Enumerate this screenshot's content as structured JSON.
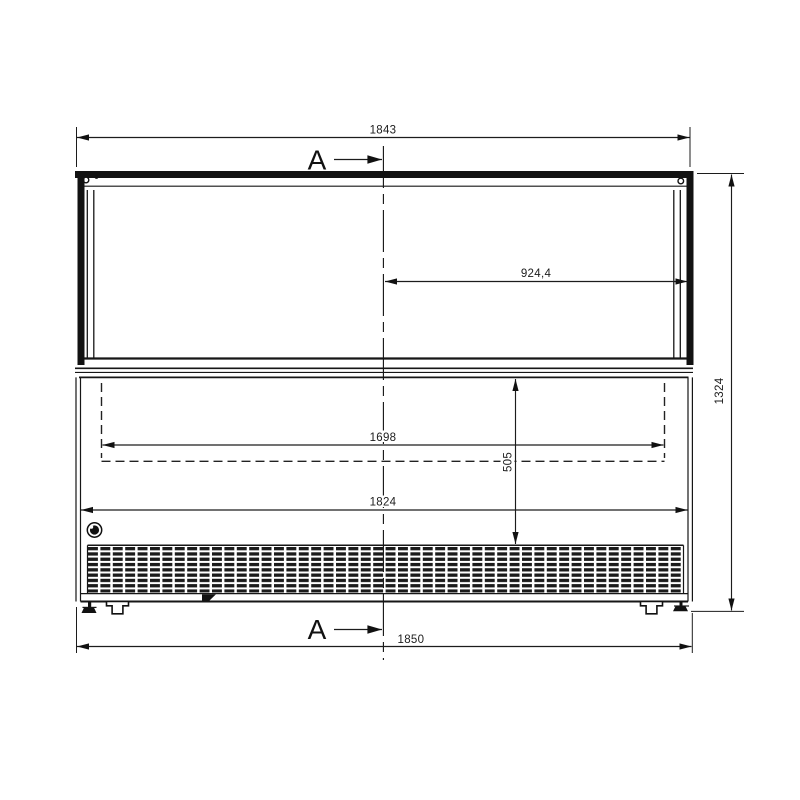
{
  "labels": {
    "section": "A"
  },
  "dims": {
    "top_width": "1843",
    "center_to_right": "924,4",
    "inner_width": "1698",
    "inner_height": "505",
    "body_width": "1824",
    "overall_width": "1850",
    "overall_height": "1324"
  }
}
